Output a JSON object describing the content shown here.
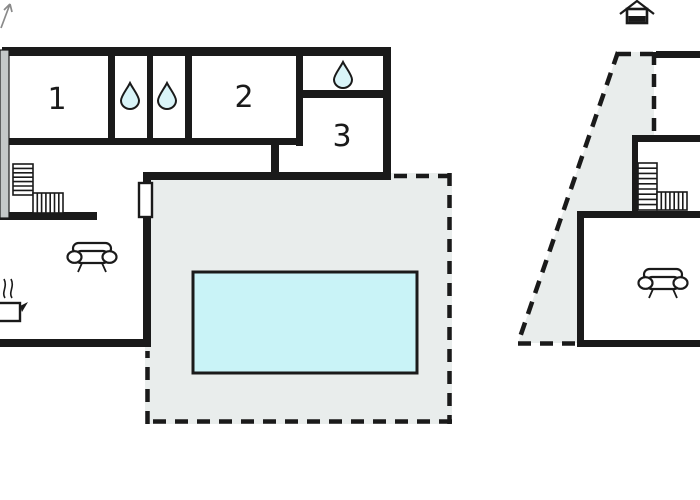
{
  "plan_type": "holiday-home-floor-plan",
  "rooms": {
    "room1": "1",
    "room2": "2",
    "room3": "3"
  },
  "icons": {
    "water_drop": "water-drop (bathroom)",
    "sofa": "sofa-top-view",
    "cooking_pot": "cooking-pot-with-steam (kitchen)",
    "stairs": "l-shaped-staircase",
    "north_house": "north-house-marker",
    "north_arrow": "north-arrow"
  },
  "colors": {
    "wall": "#1a1a1a",
    "cut_wall_gray": "#c4c8c8",
    "terrace_fill": "#e9edec",
    "pool_fill": "#c9f3f7",
    "water_drop_fill": "#d9f4f8",
    "background": "#ffffff"
  }
}
